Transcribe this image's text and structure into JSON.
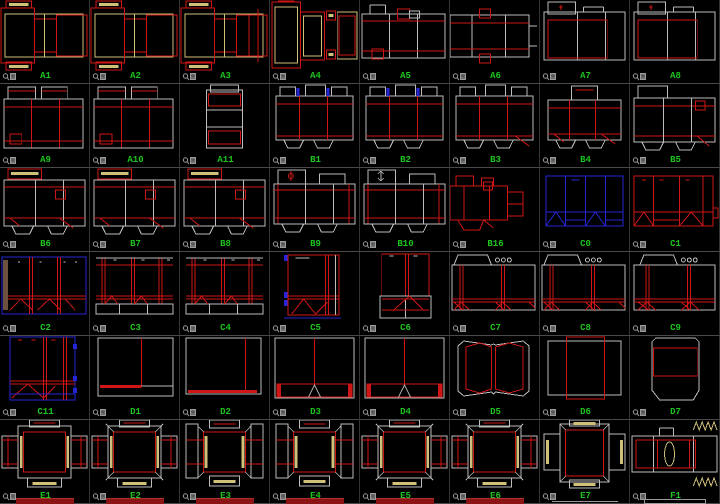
{
  "palette": {
    "background": "#000000",
    "cut_red": "#cf1616",
    "dark_red_fragment": "#8c1414",
    "crease_white": "#bdbdbd",
    "crease_yellow": "#cfc07a",
    "alt_blue": "#2626d6",
    "brown_edge": "#6b5240",
    "label_green": "#1cc41c",
    "grid_line": "#4a4a4a",
    "icon_gray": "#9a9a9a"
  },
  "icons": {
    "thumbnail_corner": "preview-icon"
  },
  "grid": {
    "columns": 8,
    "rows": 6,
    "cells": [
      {
        "label": "A1",
        "motif": "a1"
      },
      {
        "label": "A2",
        "motif": "a1"
      },
      {
        "label": "A3",
        "motif": "a3"
      },
      {
        "label": "A4",
        "motif": "a4"
      },
      {
        "label": "A5",
        "motif": "a5"
      },
      {
        "label": "A6",
        "motif": "a6"
      },
      {
        "label": "A7",
        "motif": "a7"
      },
      {
        "label": "A8",
        "motif": "a7"
      },
      {
        "label": "A9",
        "motif": "a9"
      },
      {
        "label": "A10",
        "motif": "a9"
      },
      {
        "label": "A11",
        "motif": "a11"
      },
      {
        "label": "B1",
        "motif": "b1"
      },
      {
        "label": "B2",
        "motif": "b1"
      },
      {
        "label": "B3",
        "motif": "b3"
      },
      {
        "label": "B4",
        "motif": "b4"
      },
      {
        "label": "B5",
        "motif": "b5"
      },
      {
        "label": "B6",
        "motif": "b6"
      },
      {
        "label": "B7",
        "motif": "b6"
      },
      {
        "label": "B8",
        "motif": "b6"
      },
      {
        "label": "B9",
        "motif": "b9"
      },
      {
        "label": "B10",
        "motif": "b10"
      },
      {
        "label": "B16",
        "motif": "b16"
      },
      {
        "label": "C0",
        "motif": "c0"
      },
      {
        "label": "C1",
        "motif": "c1"
      },
      {
        "label": "C2",
        "motif": "c2"
      },
      {
        "label": "C3",
        "motif": "c3"
      },
      {
        "label": "C4",
        "motif": "c3"
      },
      {
        "label": "C5",
        "motif": "c5"
      },
      {
        "label": "C6",
        "motif": "c6"
      },
      {
        "label": "C7",
        "motif": "c7"
      },
      {
        "label": "C8",
        "motif": "c7"
      },
      {
        "label": "C9",
        "motif": "c9"
      },
      {
        "label": "C11",
        "motif": "c11"
      },
      {
        "label": "D1",
        "motif": "d1"
      },
      {
        "label": "D2",
        "motif": "d2"
      },
      {
        "label": "D3",
        "motif": "d3"
      },
      {
        "label": "D4",
        "motif": "d3"
      },
      {
        "label": "D5",
        "motif": "d5"
      },
      {
        "label": "D6",
        "motif": "d6"
      },
      {
        "label": "D7",
        "motif": "d7"
      },
      {
        "label": "E1",
        "motif": "e1"
      },
      {
        "label": "E2",
        "motif": "e2"
      },
      {
        "label": "E3",
        "motif": "e3"
      },
      {
        "label": "E4",
        "motif": "e3"
      },
      {
        "label": "E5",
        "motif": "e2"
      },
      {
        "label": "E6",
        "motif": "e2"
      },
      {
        "label": "E7",
        "motif": "e7"
      },
      {
        "label": "F1",
        "motif": "f1"
      }
    ]
  }
}
